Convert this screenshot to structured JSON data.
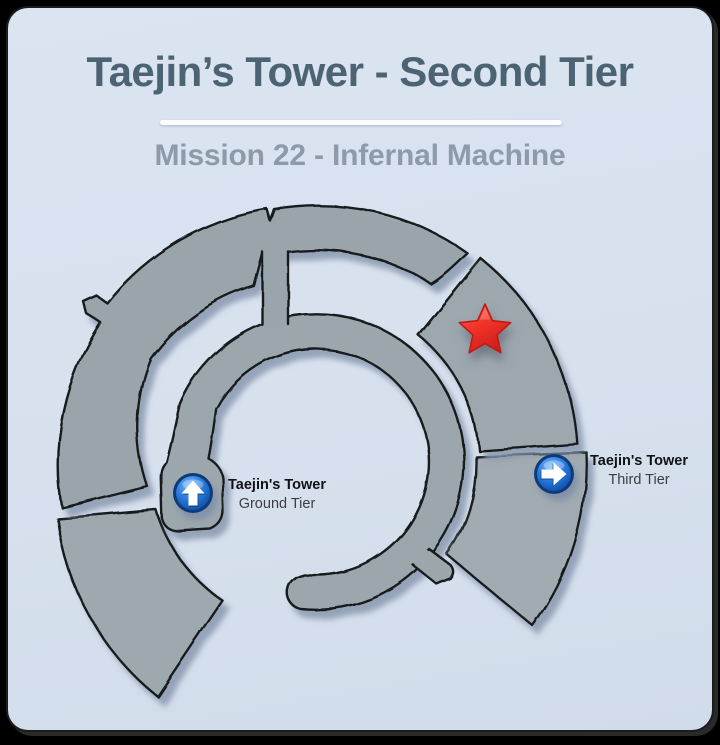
{
  "window": {
    "frame_color": "#000000",
    "card_color": "#d8e2ef"
  },
  "header": {
    "title": "Taejin’s Tower - Second Tier",
    "subtitle": "Mission 22 - Infernal Machine",
    "title_color": "#4c6373",
    "subtitle_color": "#8d9aa8"
  },
  "map": {
    "region_fill": "#9da7ae",
    "outline_color": "#171a1d",
    "shadow_color": "#8a99b0",
    "objective": {
      "marker": "red-star",
      "color": "#f23329"
    },
    "exit_icon_color": "#2f80e2",
    "exits": [
      {
        "icon": "arrow-up-circle-icon",
        "name": "Taejin's Tower",
        "tier": "Ground Tier"
      },
      {
        "icon": "arrow-right-circle-icon",
        "name": "Taejin's Tower",
        "tier": "Third Tier"
      }
    ]
  }
}
